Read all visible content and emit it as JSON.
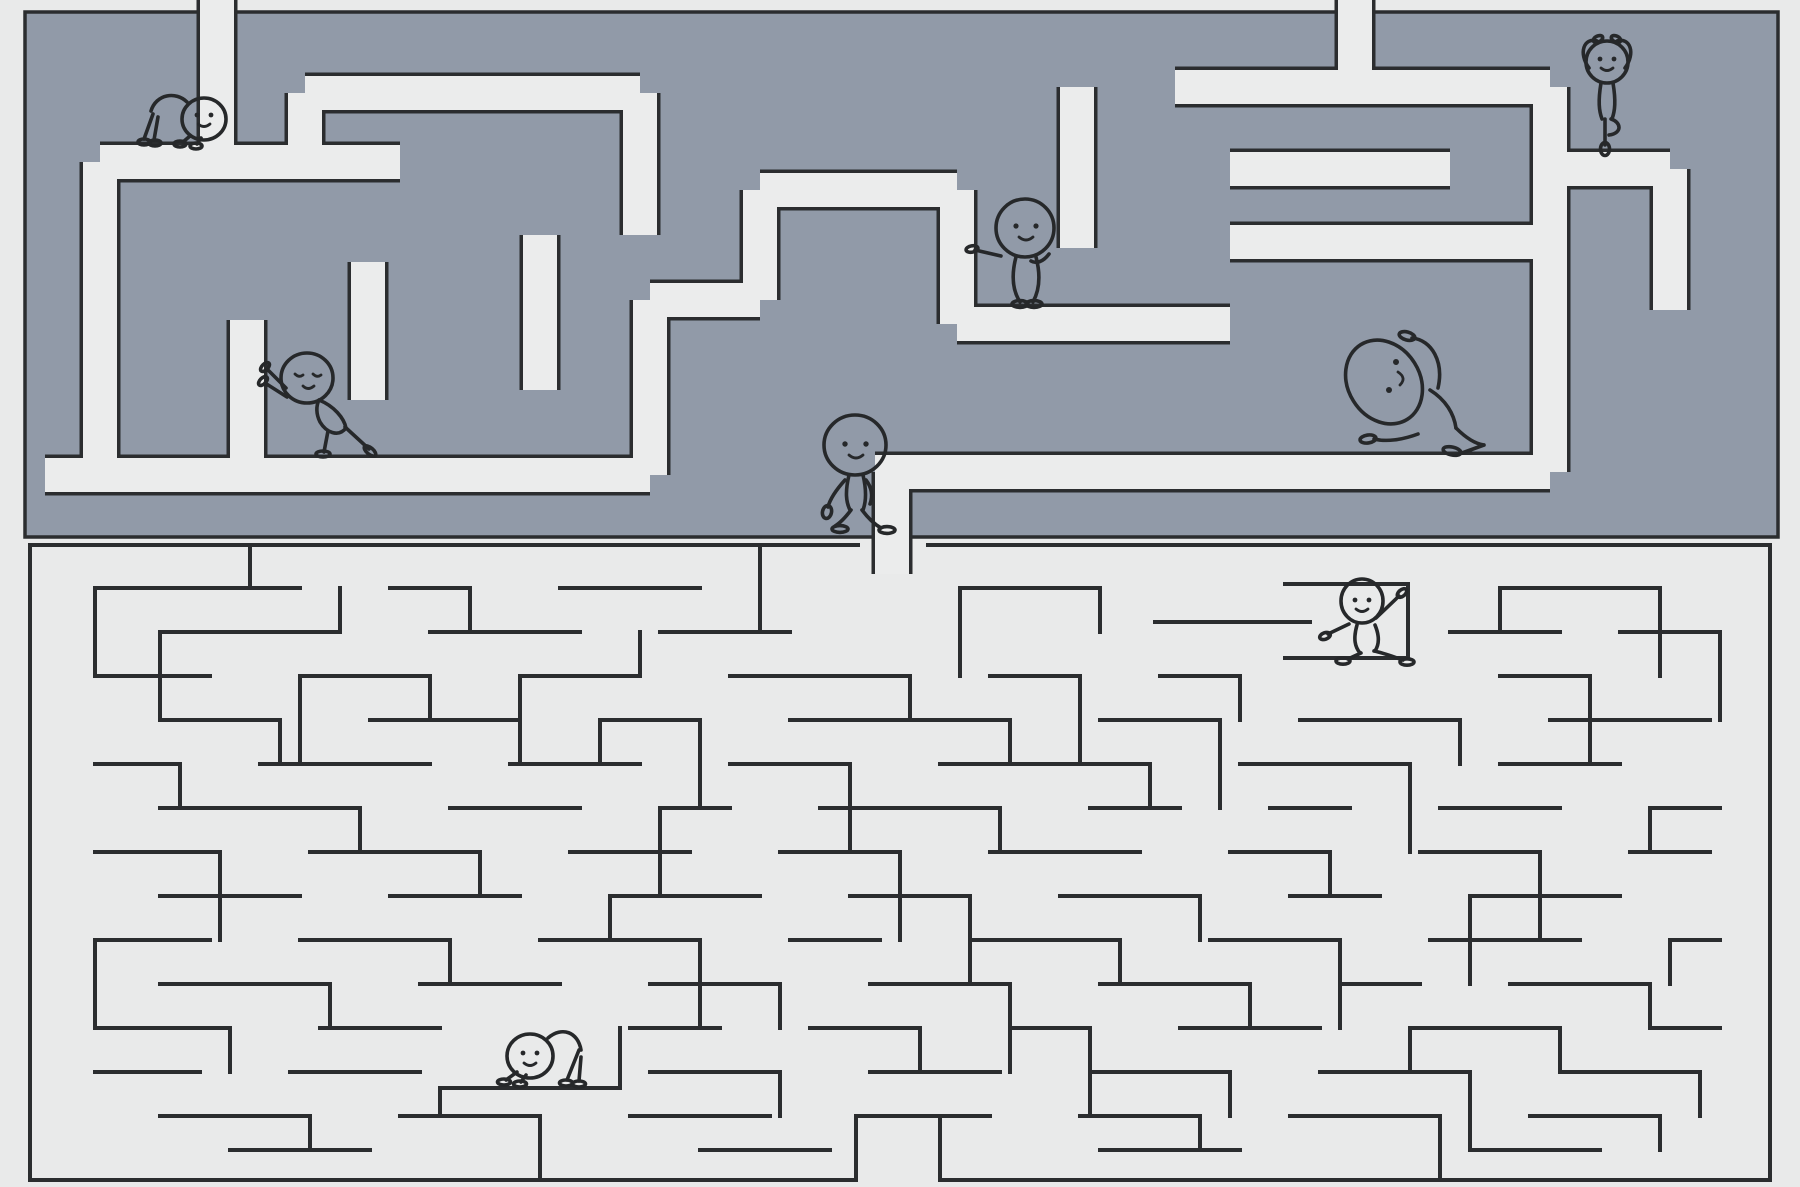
{
  "page": {
    "title": "Yoga stick-figure double maze",
    "description": "Illustration of two stacked rectangular mazes. The upper maze is a solid slate-blue block with light carved corridors (entrance slot at the top left, exit slot at the bottom centre). The lower maze is drawn with thin dark single lines on a light background. Eight smiling round-headed stick figures hold yoga poses throughout the mazes. No text is visible in the image."
  },
  "colors": {
    "background": "#ebecec",
    "page_margin": "#e9eaea",
    "maze_fill": "#919aa8",
    "line": "#2b2d2f",
    "figure_line": "#26282a"
  },
  "top_maze": {
    "style": "solid slate block with carved light corridors",
    "border": {
      "x": 25,
      "y": 12,
      "width": 1753,
      "height": 525
    },
    "corridor_width": 34,
    "corridors_d": "M217,-8 L217,162 M100,162 L400,162 M100,162 L100,475 M45,475 L650,475 M247,320 L247,475 M368,262 L368,400 M540,235 L540,390 M305,93 L305,162 M305,93 L640,93 M640,93 L640,235 M650,300 L650,475 M650,300 L760,300 M760,190 L760,300 M760,190 L957,190 M957,190 L957,324 M957,324 L1230,324 M1077,87 L1077,248 M1175,87 L1550,87 M1355,-8 L1355,87 M1550,87 L1550,472 M1230,242 L1550,242 M1230,169 L1450,169 M1550,169 L1670,169 M1670,169 L1670,310 M875,472 L1550,472 M892,472 L892,574"
  },
  "bottom_maze": {
    "style": "thin single-line wall maze",
    "walls_d": "M30,545 H858 M928,545 H1770 M30,545 V1180 M1770,545 V1180 M30,1180 H856 M940,1180 H1770 M95,588H300 M390,588H470 M560,588H700 M960,588H1100 M1500,588H1660 M1285,584H1408 M1408,584V658 M1285,658H1408 M1155,622H1310 M160,632H340 M430,632H580 M660,632H790 M1450,632H1560 M1620,632H1720 M95,676H210 M300,676H430 M520,676H640 M730,676H910 M990,676H1080 M1160,676H1240 M1500,676H1590 M160,720H280 M370,720H520 M600,720H700 M790,720H1010 M1100,720H1220 M1300,720H1460 M1550,720H1710 M95,764H180 M260,764H430 M510,764H640 M730,764H850 M940,764H1150 M1240,764H1410 M1500,764H1620 M160,808H360 M450,808H580 M660,808H730 M820,808H1000 M1090,808H1180 M1270,808H1350 M1440,808H1560 M1650,808H1720 M95,852H220 M310,852H480 M570,852H690 M780,852H900 M990,852H1140 M1230,852H1330 M1420,852H1540 M1630,852H1710 M160,896H300 M390,896H520 M610,896H760 M850,896H970 M1060,896H1200 M1290,896H1380 M1470,896H1620 M95,940H210 M300,940H450 M540,940H700 M790,940H880 M970,940H1120 M1210,940H1340 M1430,940H1580 M1670,940H1720 M160,984H330 M420,984H560 M650,984H780 M870,984H1010 M1100,984H1250 M1340,984H1420 M1510,984H1650 M95,1028H230 M320,1028H440 M630,1028H720 M810,1028H920 M1010,1028H1090 M1180,1028H1320 M1410,1028H1560 M1650,1028H1720 M440,1088H620 M95,1072H200 M290,1072H420 M650,1072H780 M870,1072H1000 M1090,1072H1230 M1320,1072H1470 M1560,1072H1700 M160,1116H310 M400,1116H540 M630,1116H770 M860,1116H990 M1080,1116H1200 M1290,1116H1440 M1530,1116H1660 M230,1150H370 M700,1150H830 M1100,1150H1240 M1470,1150H1600 M95,588V676 M250,545V588 M340,588V632 M470,588V632 M640,632V676 M760,545V632 M960,588V676 M1100,588V632 M1500,588V632 M1660,588V676 M1720,632V720 M160,632V720 M300,676V764 M430,676V720 M520,676V764 M910,676V720 M1080,676V764 M1240,676V720 M1590,676V764 M280,720V764 M600,720V764 M700,720V808 M1010,720V764 M1220,720V808 M1460,720V764 M180,764V808 M850,764V852 M1150,764V808 M1410,764V852 M360,808V852 M660,808V896 M1000,808V852 M1650,808V852 M220,852V940 M480,852V896 M900,852V940 M1330,852V896 M1540,852V940 M610,896V940 M970,896V984 M1200,896V940 M1470,896V984 M95,940V1028 M450,940V984 M700,940V1028 M1120,940V984 M1340,940V1028 M1670,940V984 M330,984V1028 M780,984V1028 M1010,984V1072 M1250,984V1028 M1650,984V1028 M230,1028V1072 M920,1028V1072 M1090,1028V1116 M1410,1028V1072 M1560,1028V1072 M440,1088V1116 M620,1028V1088 M780,1072V1116 M1230,1072V1116 M1470,1072V1150 M1700,1072V1116 M310,1116V1150 M540,1116V1180 M856,1116V1180 M940,1116V1180 M1200,1116V1150 M1440,1116V1180 M1660,1116V1150"
  },
  "figures": [
    {
      "id": "downward-dog-top-left",
      "pose": "downward dog",
      "maze": "top",
      "transform": "translate(140,90)"
    },
    {
      "id": "wall-push-stretch",
      "pose": "wall push stretch",
      "maze": "top",
      "transform": "translate(262,348)"
    },
    {
      "id": "standing-side-reach",
      "pose": "standing arm reach",
      "maze": "top",
      "transform": "translate(973,196)"
    },
    {
      "id": "tree-pose",
      "pose": "tree pose, arms overhead",
      "maze": "top",
      "transform": "translate(1574,31)"
    },
    {
      "id": "walker-at-exit",
      "pose": "walking between the mazes",
      "maze": "top",
      "transform": "translate(806,412)"
    },
    {
      "id": "seated-side-bend",
      "pose": "seated side bend, big tilted head",
      "maze": "top",
      "transform": "translate(1332,318)"
    },
    {
      "id": "warrior-lunge",
      "pose": "warrior lunge, one arm raised",
      "maze": "bottom",
      "transform": "translate(1316,571)"
    },
    {
      "id": "downward-dog-bottom",
      "pose": "downward dog",
      "maze": "bottom",
      "transform": "translate(492,1022)"
    }
  ]
}
